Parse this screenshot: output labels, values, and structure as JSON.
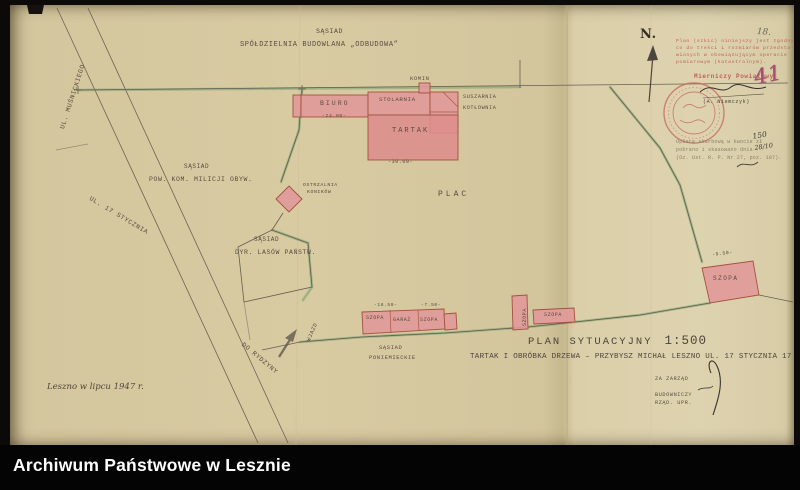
{
  "colors": {
    "paper": "#d7c9a1",
    "building_fill": "#e1999a",
    "boundary_green": "#7ea371",
    "stamp_red": "#c4665c",
    "crayon_red": "#a34f70"
  },
  "archive_bar": {
    "title": "Archiwum Państwowe w Lesznie"
  },
  "north_label": "N.",
  "annotations": {
    "pencil_number": "18.",
    "red_number": "41"
  },
  "plan": {
    "neighbors": {
      "north": {
        "prefix": "SĄSIAD",
        "name": "SPÓŁDZIELNIA BUDOWLANA „ODBUDOWA”"
      },
      "west": {
        "prefix": "SĄSIAD",
        "name": "POW. KOM. MILICJI OBYW."
      },
      "southwest": {
        "prefix": "SĄSIAD",
        "name": "DYR. LASÓW PAŃSTW."
      },
      "south": {
        "prefix": "SĄSIAD",
        "name": "PONIEMIECKIE"
      }
    },
    "streets": {
      "musnickiego": "UL. MUŚNICKIEGO",
      "stycznia": "UL. 17 STYCZNIA",
      "rydzyny": "DO RYDZYNY",
      "entrance": "WJAZD"
    },
    "labels": {
      "plac": "PLAC",
      "komin": "KOMIN",
      "suszarnia": "SUSZARNIA",
      "kotlownia": "KOTŁOWNIA",
      "biuro": "BIURO",
      "stolarnia": "STOLARNIA",
      "tartak": "TARTAK",
      "ostrzalnia_line1": "OSTRZALNIA",
      "ostrzalnia_line2": "KONIKÓW",
      "szopa1": "SZOPA",
      "garaz": "GARAŻ",
      "szopa2": "SZOPA",
      "szopa3": "SZOPA",
      "szopa4": "SZOPA",
      "szopa5": "SZOPA"
    },
    "dimensions": {
      "biuro": "-24.00-",
      "tartak": "-30.00-",
      "sheds_row": "-18.50-",
      "sheds_row2": "-7.50-",
      "szopa5": "-9.50-"
    }
  },
  "title_block": {
    "label": "PLAN SYTUACYJNY",
    "scale": "1:500",
    "subject": "TARTAK I OBRÓBKA DRZEWA – PRZYBYSZ MICHAŁ  LESZNO  UL. 17 STYCZNIA 17"
  },
  "date_note": "Leszno w lipcu 1947 r.",
  "approval": {
    "line1": "ZA ZARZĄD",
    "line2": "BUDOWNICZY",
    "line3": "RZĄD. UPR."
  },
  "surveyor_stamp": {
    "body": [
      "Plan (szkic) niniejszy jest zgodny",
      "co do treści i rozmiarów przedsta-",
      "wionych w obowiązującym operacie",
      "pomiarowym (katastralnym)."
    ],
    "title": "Mierniczy Powiatowy",
    "name": "(A. Niemczyk)"
  },
  "fee_stamp": {
    "line1": "Opłatę skarbową w kwocie zł",
    "amount": "150",
    "line2": "pobrano i skasowano dnia",
    "date": "28/10",
    "line3": "(Dz. Ust. R. P. Nr 27, poz. 107)."
  }
}
